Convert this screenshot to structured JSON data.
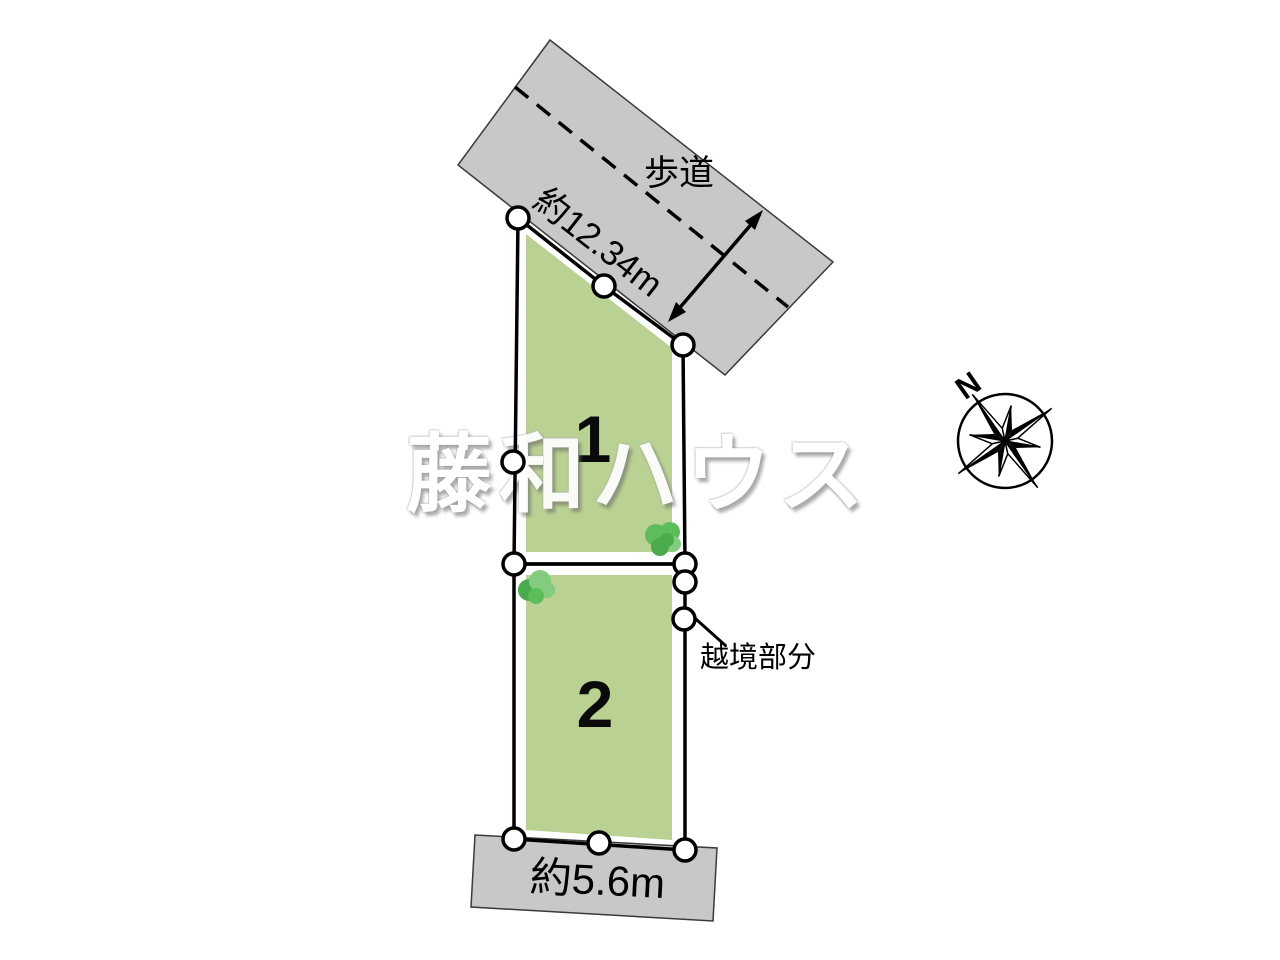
{
  "watermark": {
    "text": "藤和ハウス"
  },
  "road_top": {
    "name_label": "歩道",
    "frontage_dimension": "約12.34m"
  },
  "road_bottom": {
    "width_dimension": "約5.6m"
  },
  "parcels": [
    {
      "number": "1"
    },
    {
      "number": "2"
    }
  ],
  "annotations": {
    "encroachment_label": "越境部分"
  },
  "compass": {
    "north_label": "N"
  },
  "colors": {
    "road_fill": "#c8c8c8",
    "road_edge": "#3a3a3a",
    "parcel_fill": "#b9d192",
    "tree_light": "#83cb7e",
    "tree_mid": "#5cbd5b",
    "tree_dark": "#49ab4c",
    "outline": "#000000",
    "marker_fill": "#ffffff"
  }
}
